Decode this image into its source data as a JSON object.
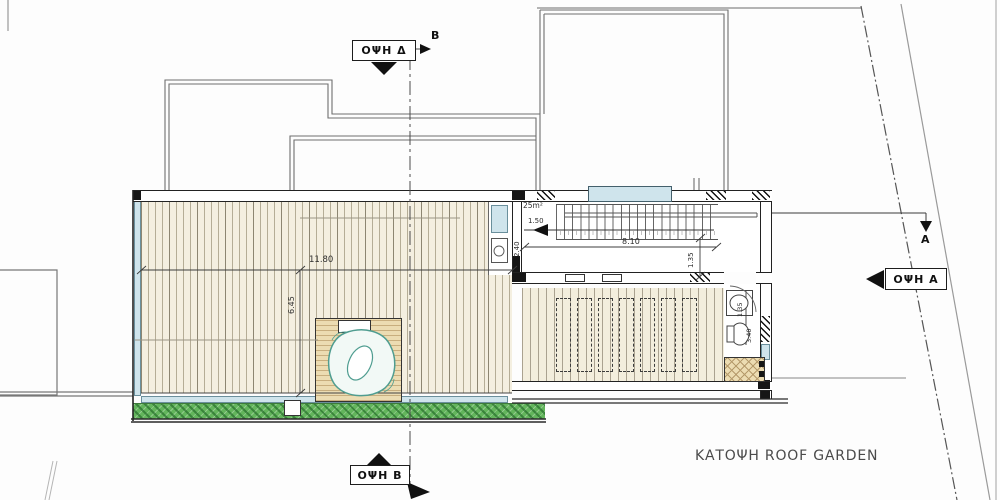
{
  "title": "ΚΑΤΟΨΗ ROOF GARDEN",
  "view_labels": {
    "top": "ΟΨΗ Δ",
    "bottom": "ΟΨΗ B",
    "right": "ΟΨΗ A"
  },
  "section_markers": {
    "b": "B",
    "a": "A"
  },
  "dimensions": {
    "deck_width": "11.80",
    "deck_depth": "6.45",
    "stair_room_area": "25m²",
    "stair_entry": "1.50",
    "stair_width": "2.40",
    "stair_run": "8.10",
    "stair_landing": "1.35",
    "wc_width": "1.35",
    "wc_length": "3.40"
  },
  "colors": {
    "deck_fill": "#f4efe0",
    "slat_line": "#b5ad96",
    "glass": "#cfe4ec",
    "planting_green": "#63b55c",
    "wall_black": "#161616",
    "jacuzzi_hatch": "#ecdcb2",
    "tub_outline": "#4f9d90",
    "drawing_line": "#555555"
  }
}
